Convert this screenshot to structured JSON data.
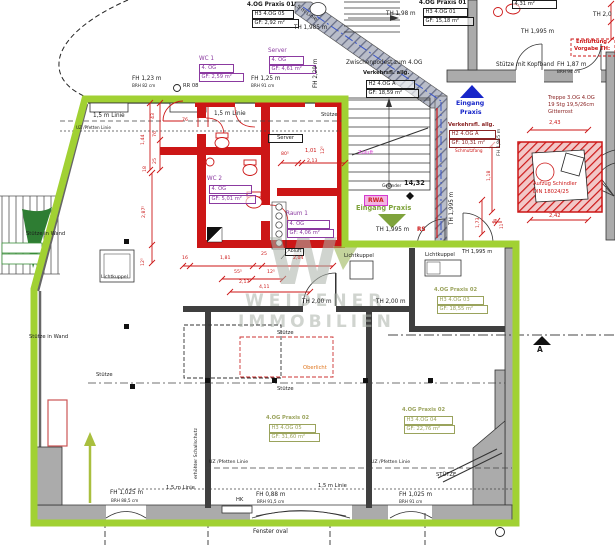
{
  "drawing": {
    "watermark": {
      "logo": "W",
      "line1": "WEIDENER",
      "line2": "IMMOBILIEN"
    },
    "colors": {
      "highlight_green": "#a1d133",
      "wall_red": "#cc1616",
      "room_purple": "#8b3aa0",
      "room_olive": "#9aa35c",
      "entry_blue": "#1726c9",
      "entry_green": "#7fa33c",
      "magenta": "#d43bd0",
      "oberlicht_orange": "#e0761e"
    }
  },
  "rooms": [
    {
      "title": "4.OG Praxis 01",
      "code": "H3 4.OG 05",
      "area": "GF:  2,92 m²"
    },
    {
      "title": "4.OG Praxis 01",
      "code": "H3 4.OG 01",
      "area": "GF: 15,18 m²"
    },
    {
      "area": "4,31 m²"
    },
    {
      "title": "WC 1",
      "code": "4. OG",
      "area": "GF: 2,59 m²"
    },
    {
      "title": "Server",
      "code": "4. OG",
      "area": "GF: 4,61 m²"
    },
    {
      "title": "WC 2",
      "code": "4. OG",
      "area": "GF: 5,01 m²"
    },
    {
      "title": "Raum 1",
      "code": "4. OG",
      "area": "GF: 4,06 m²"
    },
    {
      "title": "Zwischenpodest zum 4.OG",
      "sub": "Verkehrsfl. allg.",
      "code": "H2 4.OG A",
      "area": "GF: 18,59 m²"
    },
    {
      "sub": "Verkehrsfl. allg.",
      "code": "H2 4.OG A",
      "area": "GF: 10,31 m²"
    },
    {
      "title": "4.OG Praxis 02",
      "code": "H3 4.OG 03",
      "area": "GF: 18,55 m²"
    },
    {
      "title": "4.OG Praxis 02",
      "code": "H3 4.OG 05",
      "area": "GF: 31,60 m²"
    },
    {
      "title": "4.OG Praxis 02",
      "code": "H3 4.OG 04",
      "area": "GF: 22,76 m²"
    }
  ],
  "labels": {
    "fh123": "FH 1,23 m",
    "brh82": "BRH 82 cm",
    "rr08": "RR 08",
    "linie15": "1,5 m Linie",
    "uz": "UZ /Pfetten Linie",
    "fh125": "FH 1,25 m",
    "brh91": "BRH 91 cm",
    "fh229": "FH 2,29 m",
    "th1985": "TH 1,985 m",
    "th198": "TH 1,98 m",
    "th20": "TH 2,0",
    "th1995": "TH 1,995 m",
    "th200": "TH 2,00 m",
    "entl1": "Entlüftung",
    "entl2": "Vorgabe TH:",
    "stkopf": "Stütze mit Kopfband",
    "fh187": "FH 1,87 m",
    "brh94": "BRH 94 cm",
    "treppe1": "Treppe 3.OG 4.OG",
    "treppe2": "19 Stg 19,5/26cm",
    "treppe3": "Gitterrost",
    "eingang1": "Eingang",
    "eingang2": "Praxis",
    "eingangp": "Eingang Praxis",
    "fh1865": "FH 1,865 m",
    "zuluft": "Zuluft",
    "rwa": "RWA",
    "gelaender": "Geländer",
    "h1432": "14,32",
    "rs": "RS",
    "abluft": "Abluft",
    "lichtkuppel": "Lichtkuppel",
    "stuetze": "Stütze",
    "stuetzewand": "Stütze in Wand",
    "stuetzecaps": "STÜTZE",
    "oberlicht": "Oberlicht",
    "schall": "erhöhter Schallschutz",
    "fh1025": "FH 1,025 m",
    "brh885": "BRH 88,5 cm",
    "brh91b": "BRH 91 cm",
    "fh088": "FH 0,88 m",
    "brh915": "BRH 91,5 cm",
    "hk": "HK",
    "fensteroval": "Fenster oval",
    "section_a": "A",
    "serverroom": "Server",
    "aufzug1": "Aufzug Schindler",
    "aufzug2": "DIN 18024/25",
    "schmutzfang": "Schmutzfang"
  },
  "dims": {
    "d16": "16",
    "d18": "18",
    "d25": "25",
    "d43": "43",
    "d76": "76",
    "d144": "1,44",
    "d2875": "2,87⁵",
    "d125": "12⁵",
    "d181": "1,81",
    "d204": "2,04",
    "d555": "55⁵",
    "d213": "2,13",
    "d411": "4,11",
    "d805": "80⁵",
    "d101": "1,01",
    "d118": "1,18",
    "d173": "1,73",
    "d243": "2,43",
    "d242": "2,42",
    "d39": "39",
    "d11": "11"
  }
}
